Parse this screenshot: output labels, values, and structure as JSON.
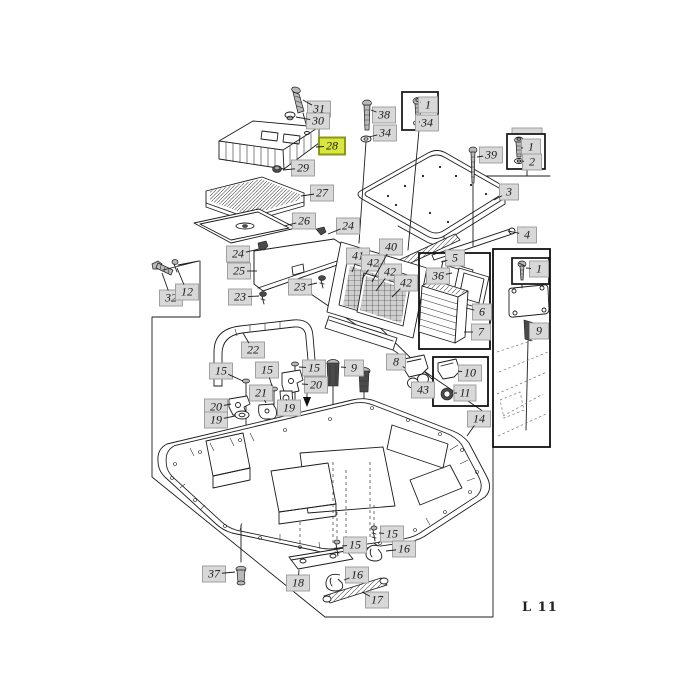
{
  "page": {
    "code": "L 11"
  },
  "colors": {
    "label_bg": "#d8d8d8",
    "highlight_bg": "#d9e63e",
    "highlight_border": "#8a971b",
    "line": "#1c1c1c"
  },
  "diagram_title": "",
  "highlighted_part": "28",
  "callouts": [
    {
      "n": "31",
      "x": 319,
      "y": 109,
      "a": [
        303,
        100
      ]
    },
    {
      "n": "30",
      "x": 318,
      "y": 121,
      "a": [
        296,
        117
      ]
    },
    {
      "n": "28",
      "x": 332,
      "y": 146,
      "hl": true,
      "a": [
        316,
        147
      ]
    },
    {
      "n": "29",
      "x": 303,
      "y": 168,
      "a": [
        283,
        170
      ]
    },
    {
      "n": "27",
      "x": 322,
      "y": 193,
      "a": [
        301,
        196
      ]
    },
    {
      "n": "26",
      "x": 304,
      "y": 221,
      "a": [
        284,
        226
      ]
    },
    {
      "n": "24",
      "x": 348,
      "y": 226,
      "a": [
        328,
        234
      ]
    },
    {
      "n": "38",
      "x": 384,
      "y": 115,
      "a": [
        371,
        110
      ]
    },
    {
      "n": "34",
      "x": 385,
      "y": 133,
      "a": [
        369,
        137
      ]
    },
    {
      "n": "1",
      "x": 428,
      "y": 105,
      "a": [
        420,
        102
      ]
    },
    {
      "n": "34",
      "x": 427,
      "y": 123,
      "a": [
        420,
        122
      ]
    },
    {
      "n": "39",
      "x": 491,
      "y": 155,
      "a": [
        477,
        157
      ]
    },
    {
      "n": "1",
      "x": 531,
      "y": 147,
      "a": [
        521,
        148
      ]
    },
    {
      "n": "2",
      "x": 532,
      "y": 162,
      "a": [
        521,
        161
      ]
    },
    {
      "n": "3",
      "x": 509,
      "y": 192,
      "a": [
        494,
        200
      ]
    },
    {
      "n": "4",
      "x": 527,
      "y": 235,
      "a": [
        508,
        231
      ]
    },
    {
      "n": "24",
      "x": 238,
      "y": 254,
      "a": [
        259,
        249
      ]
    },
    {
      "n": "25",
      "x": 239,
      "y": 271,
      "a": [
        257,
        271
      ]
    },
    {
      "n": "23",
      "x": 240,
      "y": 297,
      "a": [
        259,
        296
      ]
    },
    {
      "n": "23",
      "x": 300,
      "y": 287,
      "a": [
        317,
        283
      ]
    },
    {
      "n": "32",
      "x": 171,
      "y": 298,
      "a": [
        162,
        273
      ]
    },
    {
      "n": "12",
      "x": 187,
      "y": 292,
      "a": [
        177,
        268
      ]
    },
    {
      "n": "40",
      "x": 391,
      "y": 247,
      "a": [
        372,
        282
      ]
    },
    {
      "n": "41",
      "x": 358,
      "y": 256,
      "a": [
        352,
        272
      ]
    },
    {
      "n": "42",
      "x": 373,
      "y": 263,
      "a": [
        362,
        279
      ]
    },
    {
      "n": "42",
      "x": 390,
      "y": 272,
      "a": [
        376,
        291
      ]
    },
    {
      "n": "42",
      "x": 406,
      "y": 283,
      "a": [
        392,
        297
      ]
    },
    {
      "n": "5",
      "x": 455,
      "y": 258,
      "a": [
        441,
        262
      ]
    },
    {
      "n": "36",
      "x": 438,
      "y": 276,
      "a": [
        452,
        273
      ]
    },
    {
      "n": "6",
      "x": 482,
      "y": 312,
      "a": [
        466,
        308
      ]
    },
    {
      "n": "7",
      "x": 481,
      "y": 332,
      "a": [
        464,
        332
      ]
    },
    {
      "n": "22",
      "x": 253,
      "y": 350,
      "a": [
        243,
        333
      ]
    },
    {
      "n": "9",
      "x": 354,
      "y": 368,
      "a": [
        341,
        367
      ]
    },
    {
      "n": "8",
      "x": 396,
      "y": 362,
      "a": [
        405,
        368
      ]
    },
    {
      "n": "43",
      "x": 423,
      "y": 390,
      "a": [
        416,
        386
      ]
    },
    {
      "n": "10",
      "x": 470,
      "y": 373,
      "a": [
        458,
        371
      ]
    },
    {
      "n": "11",
      "x": 465,
      "y": 393,
      "a": [
        454,
        393
      ]
    },
    {
      "n": "14",
      "x": 479,
      "y": 419,
      "a": [
        467,
        436
      ]
    },
    {
      "n": "9",
      "x": 539,
      "y": 331,
      "a": [
        531,
        330
      ]
    },
    {
      "n": "1",
      "x": 539,
      "y": 269,
      "a": [
        526,
        268
      ]
    },
    {
      "n": "15",
      "x": 221,
      "y": 371,
      "a": [
        243,
        381
      ]
    },
    {
      "n": "15",
      "x": 267,
      "y": 370,
      "a": [
        272,
        386
      ]
    },
    {
      "n": "15",
      "x": 314,
      "y": 368,
      "a": [
        299,
        367
      ]
    },
    {
      "n": "20",
      "x": 316,
      "y": 385,
      "a": [
        302,
        384
      ]
    },
    {
      "n": "21",
      "x": 261,
      "y": 393,
      "a": [
        266,
        403
      ]
    },
    {
      "n": "19",
      "x": 289,
      "y": 408,
      "a": [
        286,
        399
      ]
    },
    {
      "n": "20",
      "x": 216,
      "y": 407,
      "a": [
        231,
        404
      ]
    },
    {
      "n": "19",
      "x": 216,
      "y": 420,
      "a": [
        235,
        416
      ]
    },
    {
      "n": "37",
      "x": 214,
      "y": 574,
      "a": [
        235,
        572
      ]
    },
    {
      "n": "18",
      "x": 298,
      "y": 583,
      "a": [
        299,
        570
      ]
    },
    {
      "n": "16",
      "x": 357,
      "y": 575,
      "a": [
        344,
        580
      ]
    },
    {
      "n": "15",
      "x": 355,
      "y": 545,
      "a": [
        342,
        546
      ]
    },
    {
      "n": "15",
      "x": 392,
      "y": 534,
      "a": [
        379,
        533
      ]
    },
    {
      "n": "16",
      "x": 404,
      "y": 549,
      "a": [
        386,
        551
      ]
    },
    {
      "n": "17",
      "x": 377,
      "y": 600,
      "a": [
        362,
        592
      ]
    }
  ],
  "page_code_pos": {
    "x": 522,
    "y": 600
  }
}
